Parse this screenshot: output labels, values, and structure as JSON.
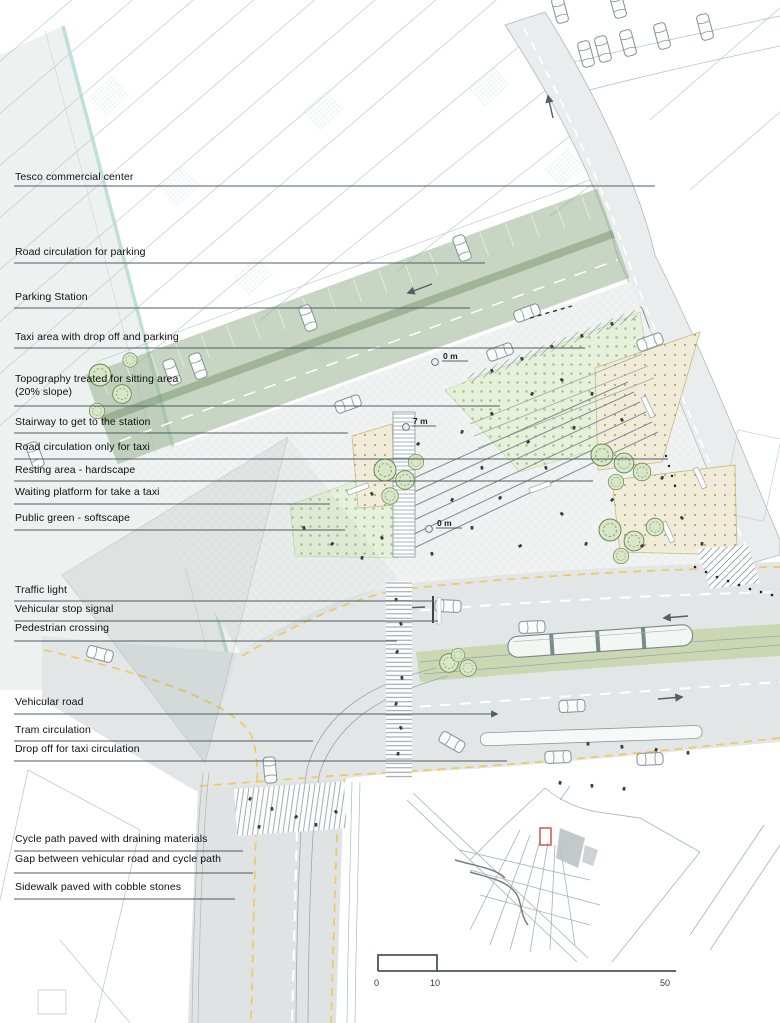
{
  "document": {
    "kind": "architectural site plan with annotations"
  },
  "labels": [
    {
      "text": "Tesco commercial center"
    },
    {
      "text": "Road circulation for parking"
    },
    {
      "text": "Parking Station"
    },
    {
      "text": "Taxi area with drop off and parking"
    },
    {
      "text": "Topography treated for sitting area\n(20% slope)"
    },
    {
      "text": "Stairway to get to the station"
    },
    {
      "text": "Road circulation only for taxi"
    },
    {
      "text": "Resting area - hardscape"
    },
    {
      "text": "Waiting platform for take a taxi"
    },
    {
      "text": "Public green - softscape"
    },
    {
      "text": "Traffic light"
    },
    {
      "text": "Vehicular stop signal"
    },
    {
      "text": "Pedestrian crossing"
    },
    {
      "text": "Vehicular road"
    },
    {
      "text": "Tram circulation"
    },
    {
      "text": "Drop off for taxi circulation"
    },
    {
      "text": "Cycle path paved with draining materials"
    },
    {
      "text": "Gap between vehicular road and cycle path"
    },
    {
      "text": "Sidewalk paved with cobble stones"
    }
  ],
  "elevation_markers": [
    {
      "text": "0 m"
    },
    {
      "text": "7 m"
    },
    {
      "text": "0 m"
    }
  ],
  "scalebar": {
    "ticks": [
      "0",
      "10",
      "50"
    ]
  },
  "inset": {
    "marker": "site-location-red-rectangle"
  },
  "colors": {
    "road": "#e2e6e6",
    "parking_band_green": "#9ab38d",
    "softscape_green": "#e6f0da",
    "tan_plaza": "#f1ecda",
    "tram_median": "#cbd7b2",
    "cycle_path_yellow": "#eec964",
    "leader_line": "#4e5d66",
    "inset_marker_red": "#cf3a2c",
    "glass_edge_teal": "#bfe0d8"
  }
}
